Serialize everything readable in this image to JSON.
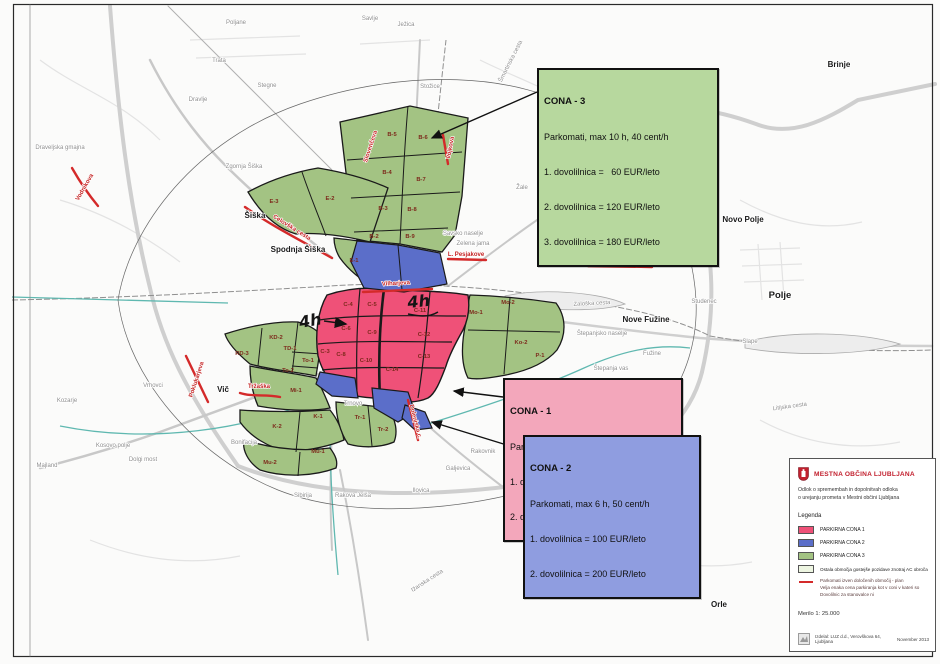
{
  "callouts": {
    "cona3": {
      "title": "CONA - 3",
      "subtitle": "Parkomati, max 10 h, 40 cent/h",
      "lines": [
        "1. dovolilnica =   60 EUR/leto",
        "2. dovolilnica = 120 EUR/leto",
        "3. dovolilnica = 180 EUR/leto"
      ],
      "bg": "#b7d89e"
    },
    "cona1": {
      "title": "CONA - 1",
      "subtitle": "Parkomati, max 2h ali 4h, 70 cent/h",
      "lines": [
        "1. dovolilnica = 100 EUR/leto",
        "2. dovolilnica = NI"
      ],
      "bg": "#f3a7bb"
    },
    "cona2": {
      "title": "CONA - 2",
      "subtitle": "Parkomati, max 6 h, 50 cent/h",
      "lines": [
        "1. dovolilnica = 100 EUR/leto",
        "2. dovolilnica = 200 EUR/leto"
      ],
      "bg": "#8f9de0"
    }
  },
  "annotations": {
    "hand_4h_left": "4h",
    "hand_4h_right": "4h"
  },
  "legend": {
    "municipality": "MESTNA OBČINA LJUBLJANA",
    "subtitle_line1": "Odlok o spremembah in dopolnitvah odloka",
    "subtitle_line2": "o urejanju prometa v Mestni občini Ljubljana",
    "heading": "Legenda",
    "zones": [
      {
        "label": "PARKIRNA CONA 1",
        "color": "#ef5178"
      },
      {
        "label": "PARKIRNA CONA 2",
        "color": "#5b6ec9"
      },
      {
        "label": "PARKIRNA CONA 3",
        "color": "#a3c383"
      }
    ],
    "other_area_label": "Ostala območja gostejše pozidave znotraj AC obroča",
    "other_area_color": "#edf5e1",
    "plan_line_color": "#d42a2a",
    "plan_note_lines": [
      "Parkomati izven določenih območij - plan",
      "Velja enaka cena parkiranja kot v coni v kateri so",
      "Dovolilnic za stanovalce ni"
    ],
    "scale": "Merilo 1: 25.000",
    "credit": "Izdelal: LUZ d.d., Verovškova 64, Ljubljana",
    "date": "November 2013"
  },
  "map": {
    "colors": {
      "cona1": "#ef5178",
      "cona2": "#5b6ec9",
      "cona3": "#a3c383",
      "red_mark": "#d42a2a"
    },
    "places": {
      "poljane": "Poljane",
      "trata": "Trata",
      "stegne": "Stegne",
      "dravlje": "Dravlje",
      "draveljska_gmajna": "Draveljska gmajna",
      "zgornja_siska": "Zgornja Šiška",
      "siska": "Šiška",
      "spodnja_siska": "Spodnja Šiška",
      "savlje": "Savlje",
      "jezica": "Ježica",
      "stozice": "Stožice",
      "tomacevo": "Tomačevo",
      "zale": "Žale",
      "nove_jarse": "Nove Jarše",
      "savsko_naselje": "Savsko naselje",
      "zelena_jama": "Zelena jama",
      "moste": "Moste",
      "brinje": "Brinje",
      "novo_polje": "Novo Polje",
      "polje": "Polje",
      "slape": "Slape",
      "studenec": "Studenec",
      "nove_fuzine": "Nove Fužine",
      "fuzine": "Fužine",
      "stepanjsko_naselje": "Štepanjsko naselje",
      "stepanja_vas": "Štepanja vas",
      "bizovik": "Bizovik",
      "vrhovci": "Vrhovci",
      "vic": "Vič",
      "kozarje": "Kozarje",
      "kosovo_polje": "Kosovo polje",
      "majland": "Majland",
      "dolgi_most": "Dolgi most",
      "bonifacija": "Bonifacija",
      "trnovo": "Trnovo",
      "sibirija": "Sibirija",
      "rakova_jelsa": "Rakova Jelša",
      "rakovnik": "Rakovnik",
      "galjevica": "Galjevica",
      "ilovica": "Ilovica",
      "london": "London",
      "rudnik": "Rudnik",
      "spodnji_rudnik": "Spodnji Rudnik",
      "orle": "Orle"
    },
    "streets": {
      "slovenceva": "Slovenčeva",
      "vojkova": "Vojkova",
      "smartinska": "Šmartinska cesta",
      "vilharjeva": "Vilharjeva",
      "pesjakove": "L. Pesjakove",
      "leskoskova": "Leskoškova",
      "letaliska": "Letališka",
      "celovska": "Celovška cesta",
      "vodnikova": "Vodnikova",
      "trzaska": "Tržaška",
      "poklukarjeva": "Poklukarjeva",
      "dolenjska": "Dolenjska c.",
      "zaloska": "Zaloška cesta",
      "litijska": "Litijska cesta",
      "izanska": "Ižanska cesta"
    },
    "zone_labels": {
      "b2": "B-2",
      "b3": "B-3",
      "b4": "B-4",
      "b5": "B-5",
      "b6": "B-6",
      "b7": "B-7",
      "b8": "B-8",
      "b9": "B-9",
      "e1": "E-1",
      "e2": "E-2",
      "e3": "E-3",
      "c3": "C-3",
      "c4": "C-4",
      "c5": "C-5",
      "c6": "C-6",
      "c8": "C-8",
      "c9": "C-9",
      "c10": "C-10",
      "c11": "C-11",
      "c12": "C-12",
      "c13": "C-13",
      "c14": "C-14",
      "mo1": "Mo-1",
      "mo2": "Mo-2",
      "ko2": "Ko-2",
      "p1": "P-1",
      "kd2": "KD-2",
      "rd3": "RD-3",
      "td1": "TD-1",
      "to1": "To-1",
      "to2": "To-2",
      "mi1": "Mi-1",
      "k1": "K-1",
      "k2": "K-2",
      "tr1": "Tr-1",
      "tr2": "Tr-2",
      "mu1": "Mu-1",
      "mu2": "Mu-2"
    }
  }
}
